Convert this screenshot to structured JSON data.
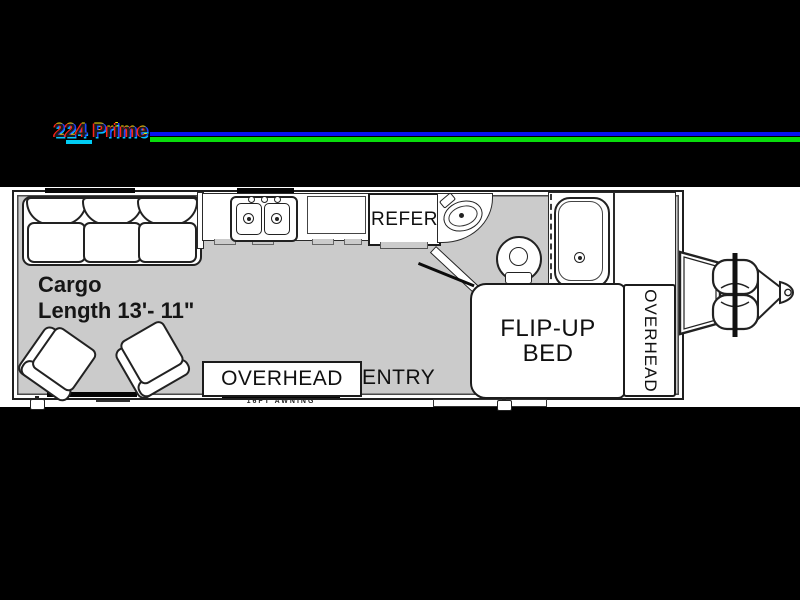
{
  "header": {
    "model_title": "224 Prime",
    "underline_blue": "#0713f2",
    "underline_green": "#09dc0c"
  },
  "floorplan": {
    "floor_color": "#cbcbcb",
    "cargo": {
      "line1": "Cargo",
      "line2": "Length 13'- 11\""
    },
    "refrigerator_label": "REFER",
    "bed": {
      "line1": "FLIP-UP",
      "line2": "BED"
    },
    "overhead_front_label": "OVERHEAD",
    "overhead_rear_label": "OVERHEAD",
    "entry_label": "ENTRY",
    "awning_label": "16FT AWNING"
  }
}
